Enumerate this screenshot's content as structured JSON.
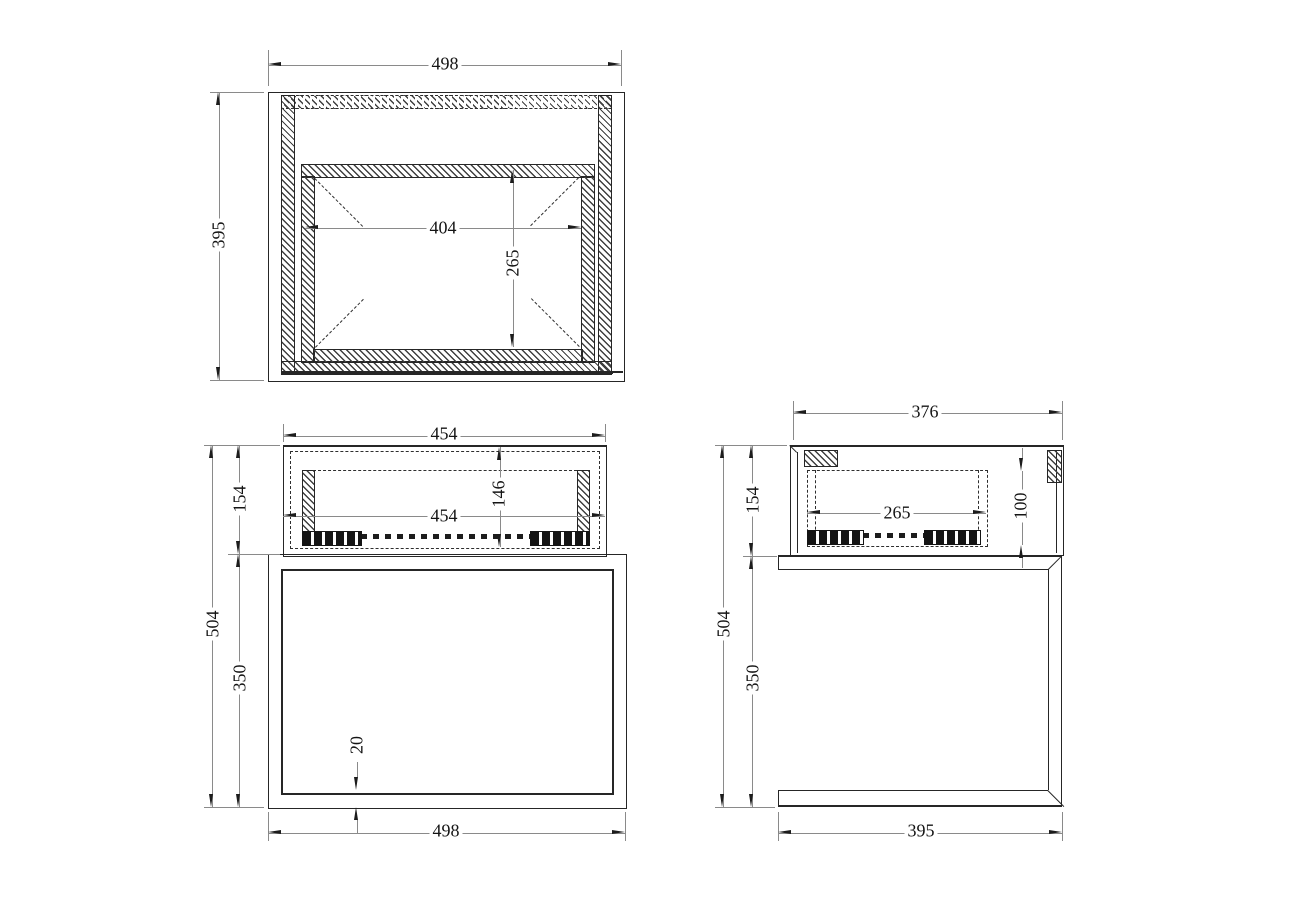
{
  "views": {
    "top": {
      "dims": {
        "overall_width": "498",
        "overall_depth": "395",
        "opening_width": "404",
        "opening_depth": "265"
      }
    },
    "front": {
      "dims": {
        "drawer_width_top": "454",
        "drawer_width": "454",
        "drawer_height": "154",
        "drawer_inner_height": "146",
        "overall_height": "504",
        "base_height": "350",
        "bottom_thickness": "20",
        "base_width": "498"
      }
    },
    "side": {
      "dims": {
        "drawer_depth": "376",
        "drawer_height": "154",
        "drawer_inner_depth": "265",
        "drawer_inner_height": "100",
        "overall_height": "504",
        "base_height": "350",
        "base_depth": "395"
      }
    }
  }
}
